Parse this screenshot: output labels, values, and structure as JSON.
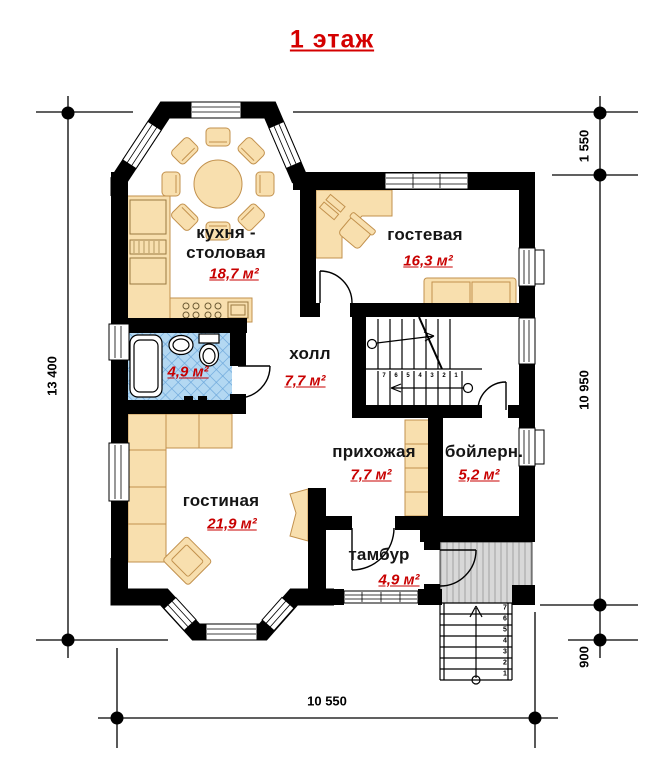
{
  "title": "1 этаж",
  "rooms": {
    "kitchen": {
      "name_line1": "кухня -",
      "name_line2": "столовая",
      "area": "18,7 м²"
    },
    "guest": {
      "name": "гостевая",
      "area": "16,3 м²"
    },
    "bathroom": {
      "area": "4,9 м²"
    },
    "hall": {
      "name": "холл",
      "area": "7,7 м²"
    },
    "entrance_hall": {
      "name": "прихожая",
      "area": "7,7 м²"
    },
    "boiler": {
      "name": "бойлерн.",
      "area": "5,2 м²"
    },
    "living": {
      "name": "гостиная",
      "area": "21,9 м²"
    },
    "vestibule": {
      "name": "тамбур",
      "area": "4,9 м²"
    }
  },
  "dimensions": {
    "left": "13 400",
    "right_top": "1 550",
    "right_middle": "10 950",
    "right_bottom": "900",
    "bottom": "10 550"
  },
  "porch_steps": [
    "1",
    "2",
    "3",
    "4",
    "5",
    "6",
    "7"
  ],
  "stair_steps": [
    "1",
    "2",
    "3",
    "4",
    "5",
    "6",
    "7"
  ],
  "colors": {
    "title_red": "#d40000",
    "area_red": "#c80000",
    "wall_black": "#000000",
    "furniture_tan": "#f8dfae",
    "bathroom_tile": "#b3d8f2",
    "porch_gray": "#d8d8d8"
  }
}
